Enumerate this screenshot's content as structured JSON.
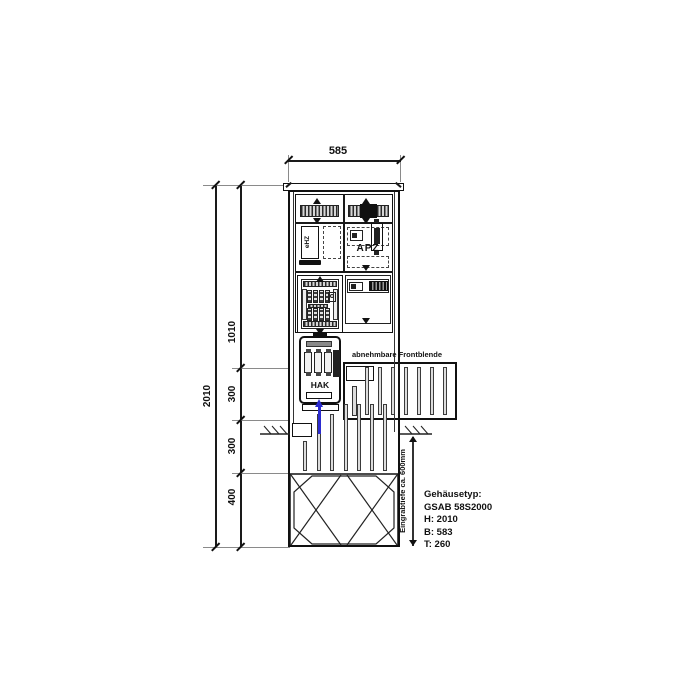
{
  "diagram": {
    "dims": {
      "width_top": "585",
      "height_total": "2010",
      "seg_1010": "1010",
      "seg_300a": "300",
      "seg_300b": "300",
      "seg_400": "400",
      "burial": "Eingrabtiefe ca. 600mm"
    },
    "labels": {
      "apz": "APZ",
      "hak": "HAK",
      "meter": "eHZ",
      "front_panel": "abnehmbare Frontblende"
    },
    "spec": {
      "line1": "Gehäusetyp:",
      "line2": "GSAB 58S2000",
      "line3": "H: 2010",
      "line4": "B: 583",
      "line5": "T: 260"
    },
    "colors": {
      "line": "#1a1a1a",
      "cable": "#2b2bd0"
    }
  }
}
